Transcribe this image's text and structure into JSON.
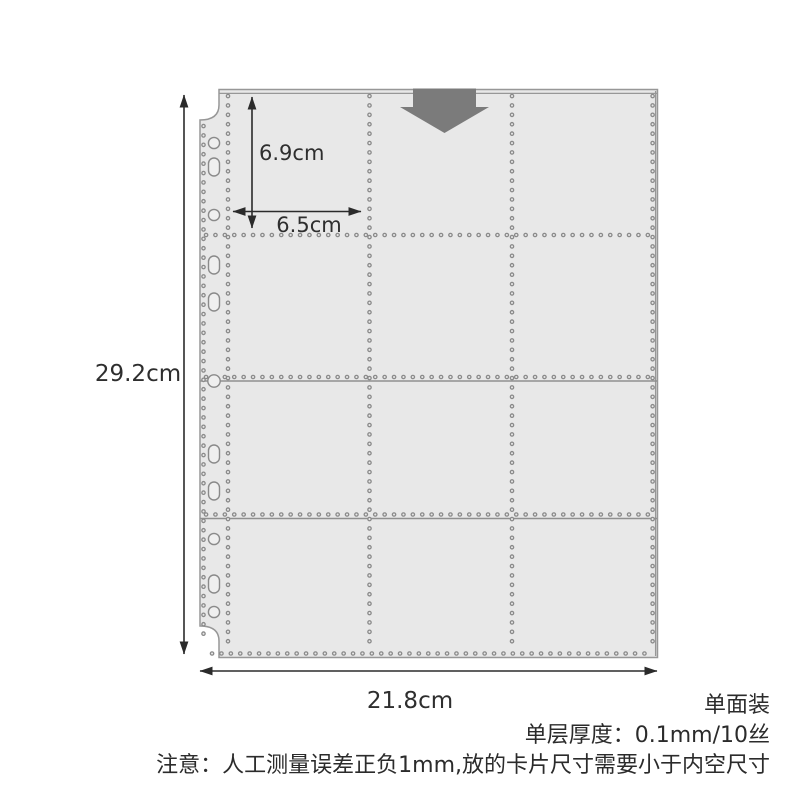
{
  "image": {
    "type": "product-dimension-diagram",
    "subject": "single-sided 12-pocket binder card page",
    "background_color": "#ffffff"
  },
  "sheet": {
    "rows": 4,
    "columns": 3,
    "pocket_count": 12,
    "binder_hole_count": 11,
    "fill_color": "#e8e8e8",
    "edge_color": "#979797",
    "stitch_color": "#8a8a8a"
  },
  "insert_arrow": {
    "name": "insert-direction-down",
    "color": "#7b7b7b"
  },
  "dimensions": {
    "page_height": "29.2cm",
    "page_width": "21.8cm",
    "pocket_height": "6.9cm",
    "pocket_width": "6.5cm"
  },
  "notes": {
    "side_label": "单面装",
    "thickness_label": "单层厚度：0.1mm/10丝",
    "caution_label": "注意：人工测量误差正负1mm,放的卡片尺寸需要小于内空尺寸"
  }
}
